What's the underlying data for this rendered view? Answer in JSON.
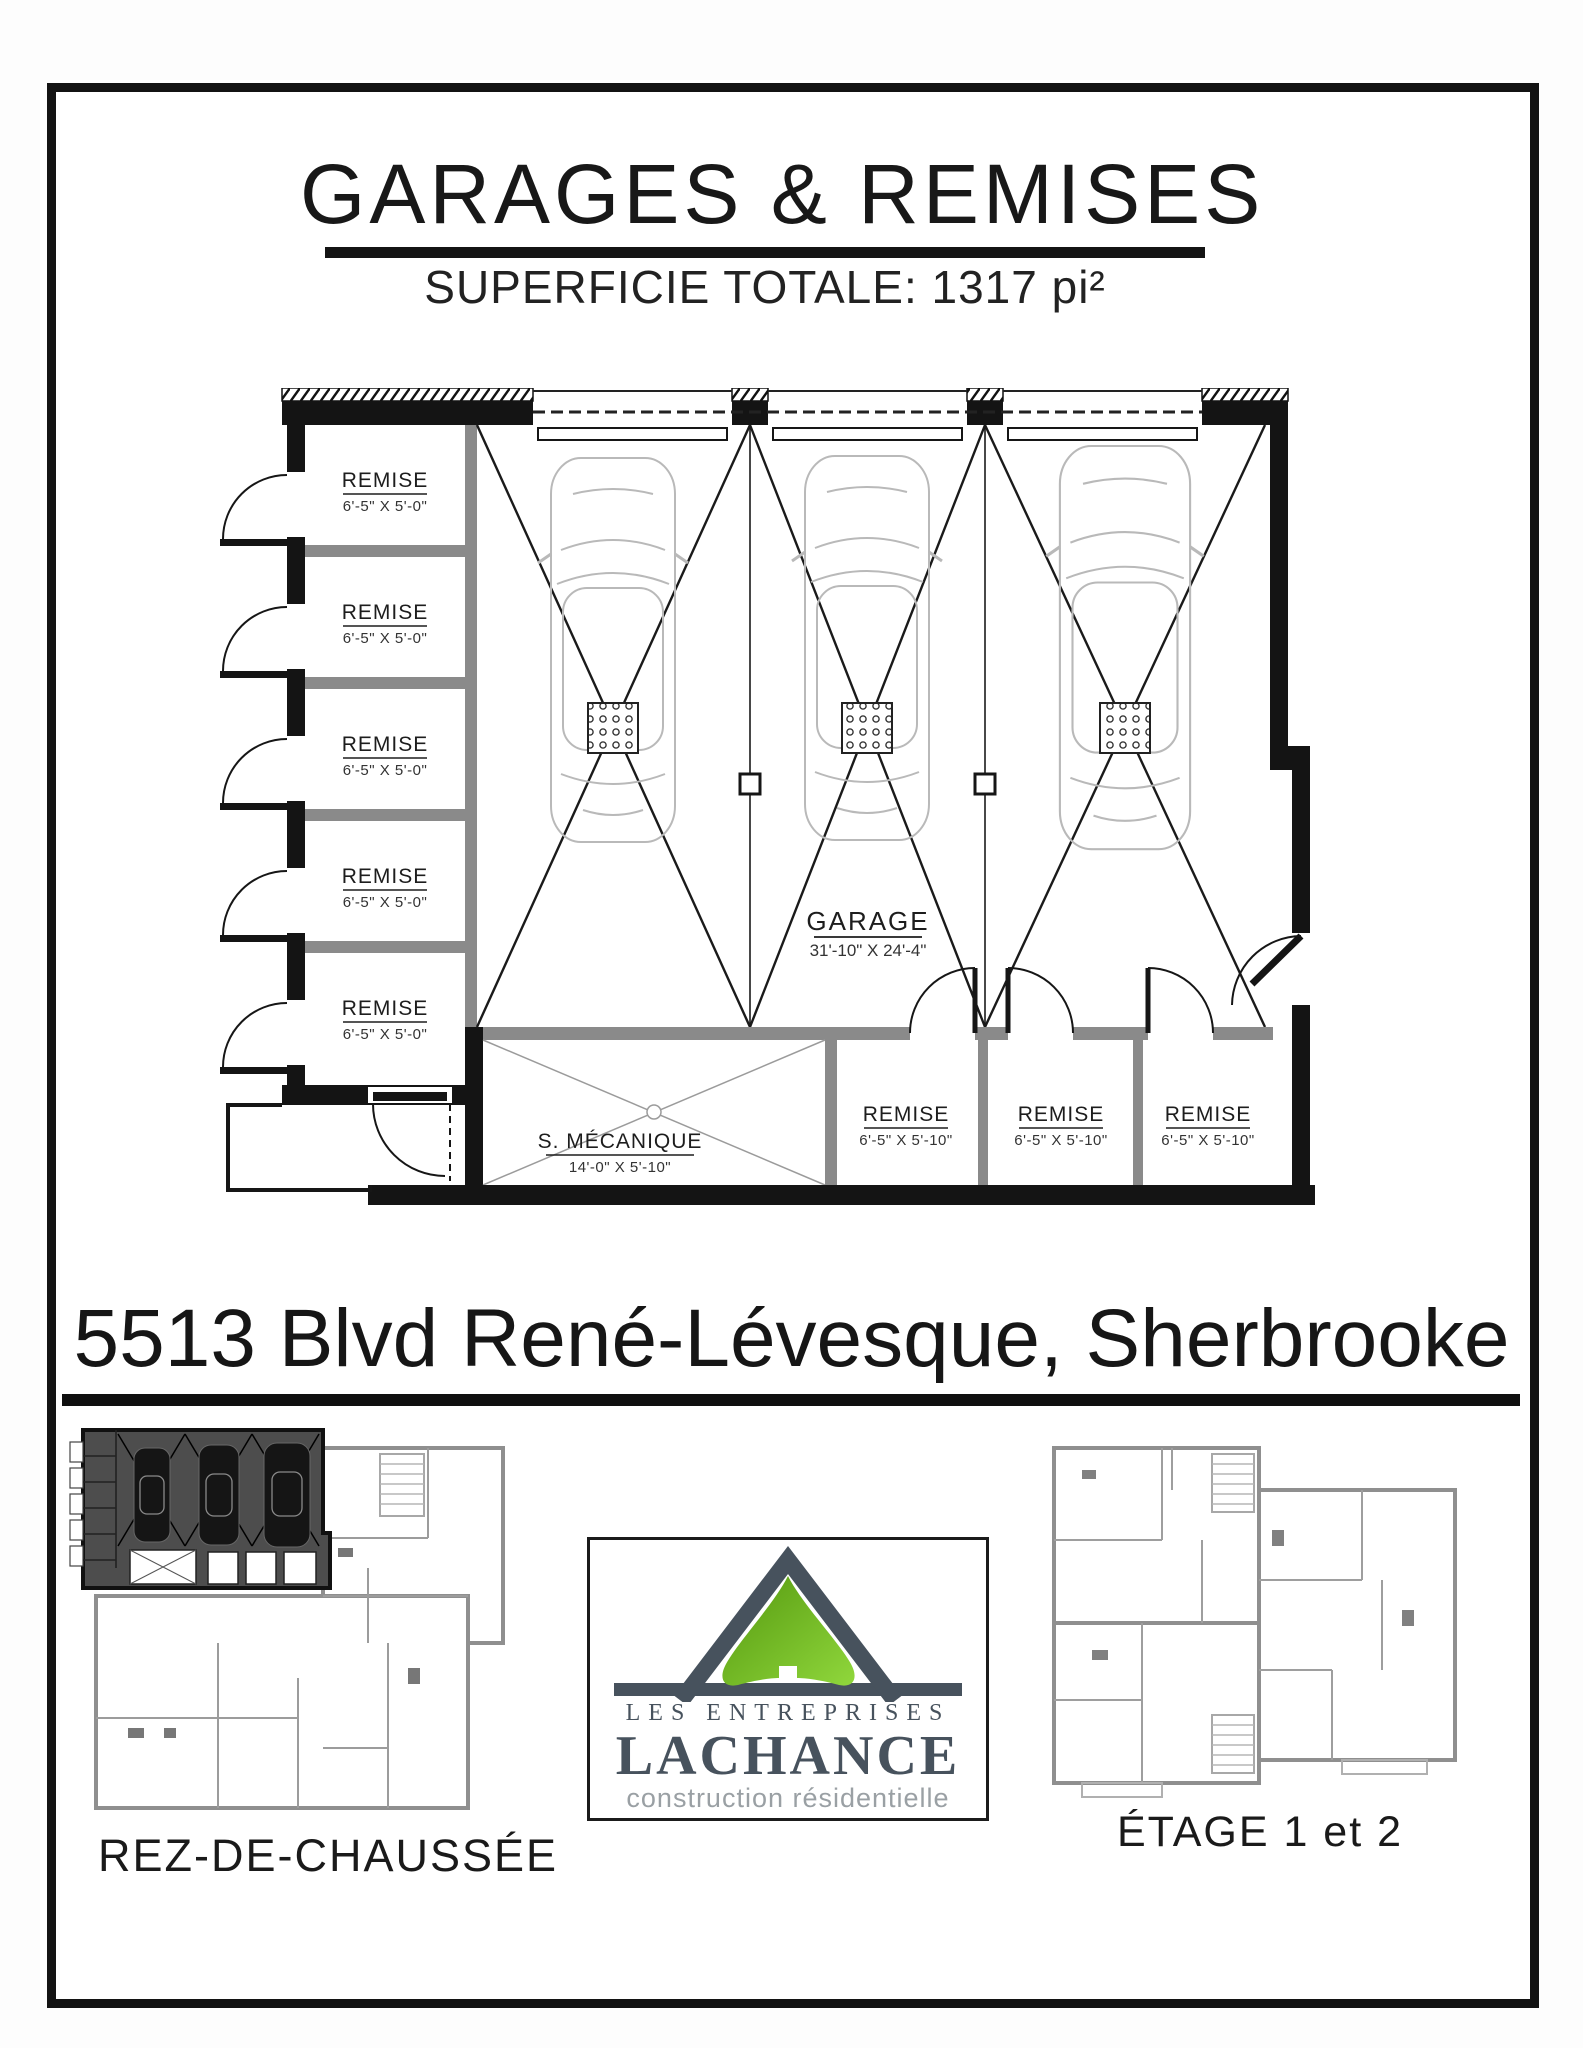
{
  "header": {
    "title": "GARAGES & REMISES",
    "subtitle": "SUPERFICIE TOTALE:  1317 pi²"
  },
  "plan": {
    "garage": {
      "name": "GARAGE",
      "dims": "31'-10\" X 24'-4\""
    },
    "mechanical_room": {
      "name": "S. MÉCANIQUE",
      "dims": "14'-0\" X 5'-10\""
    },
    "left_remises": [
      {
        "name": "REMISE",
        "dims": "6'-5\" X 5'-0\""
      },
      {
        "name": "REMISE",
        "dims": "6'-5\" X 5'-0\""
      },
      {
        "name": "REMISE",
        "dims": "6'-5\" X 5'-0\""
      },
      {
        "name": "REMISE",
        "dims": "6'-5\" X 5'-0\""
      },
      {
        "name": "REMISE",
        "dims": "6'-5\" X 5'-0\""
      }
    ],
    "bottom_remises": [
      {
        "name": "REMISE",
        "dims": "6'-5\" X 5'-10\""
      },
      {
        "name": "REMISE",
        "dims": "6'-5\" X 5'-10\""
      },
      {
        "name": "REMISE",
        "dims": "6'-5\" X 5'-10\""
      }
    ]
  },
  "address": "5513 Blvd René-Lévesque, Sherbrooke",
  "footer": {
    "left_plan_label": "REZ-DE-CHAUSSÉE",
    "right_plan_label": "ÉTAGE 1 et 2",
    "logo": {
      "line1": "LES ENTREPRISES",
      "line2": "LACHANCE",
      "line3": "construction résidentielle",
      "colors": {
        "slate": "#47525d",
        "green_dark": "#55990f",
        "green_light": "#90d73c"
      }
    }
  }
}
